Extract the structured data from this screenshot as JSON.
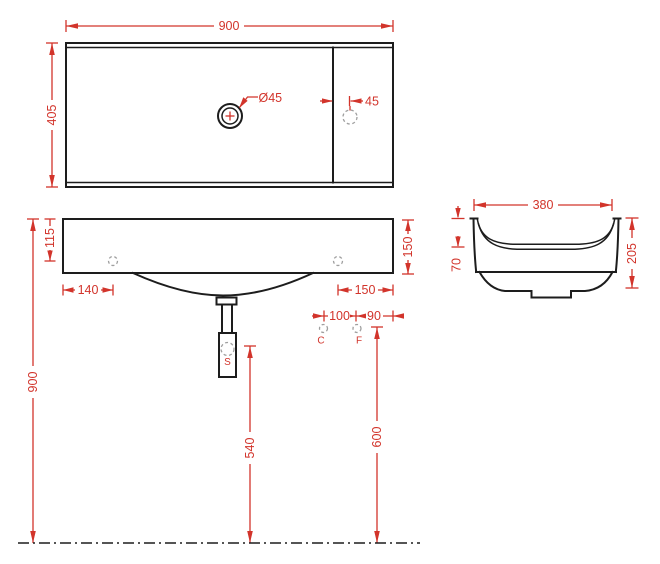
{
  "drawing": {
    "type": "washbasin technical dimension drawing",
    "colors": {
      "dimension_red": "#d2342b",
      "outline_black": "#1d1d1d",
      "hidden_gray": "#9f9f9f"
    },
    "labels": {
      "top_width": "900",
      "top_depth": "405",
      "drain_diameter": "Ø45",
      "faucet_offset": "45",
      "hole_top_offset": "115",
      "front_right_height": "150",
      "hole_left_offset": "140",
      "hole_right_offset": "150",
      "supply_spacing": "100",
      "supply_edge_offset": "90",
      "cold_supply": "C",
      "hot_supply": "F",
      "siphon": "S",
      "mount_height": "900",
      "siphon_height": "540",
      "supply_height": "600",
      "side_width": "380",
      "side_lip_height": "70",
      "side_total_height": "205"
    }
  }
}
